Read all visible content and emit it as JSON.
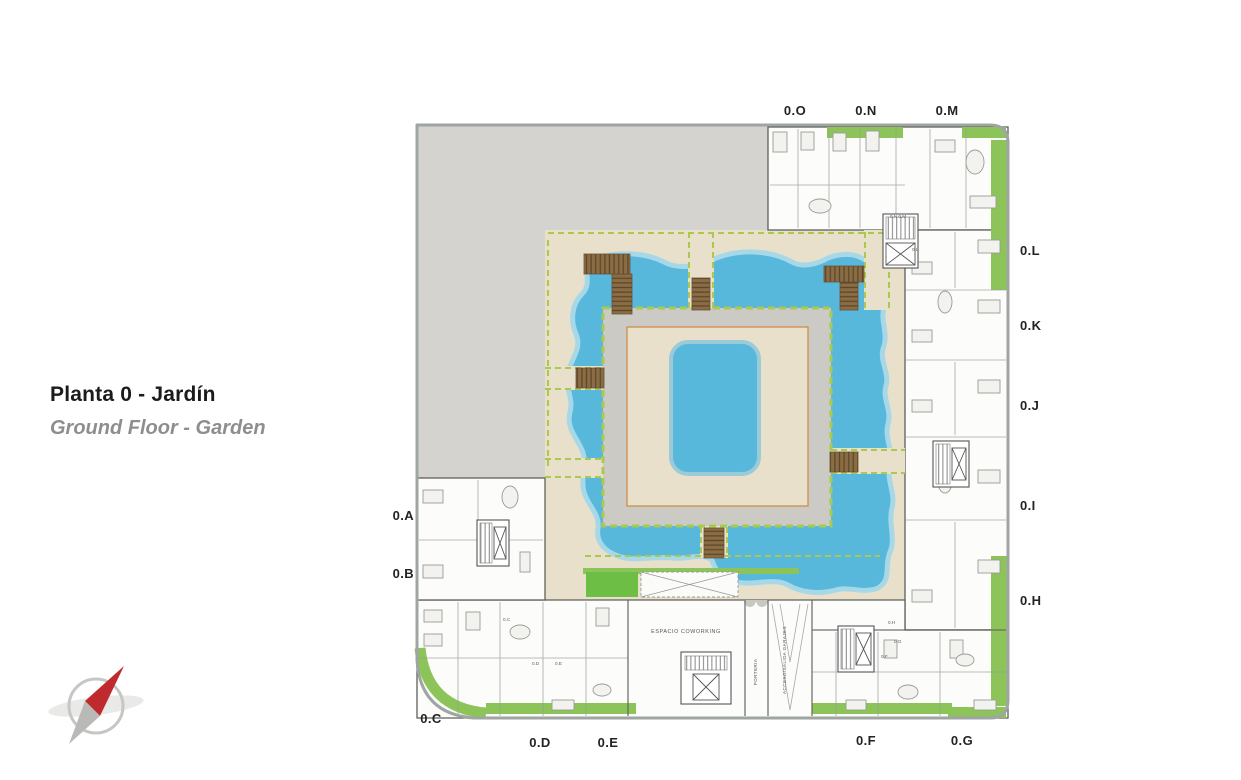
{
  "title": {
    "primary": "Planta 0 - Jardín",
    "secondary": "Ground Floor - Garden"
  },
  "plan": {
    "unit_labels": {
      "o": "0.O",
      "n": "0.N",
      "m": "0.M",
      "l": "0.L",
      "k": "0.K",
      "j": "0.J",
      "i": "0.I",
      "h": "0.H",
      "g": "0.G",
      "f": "0.F",
      "e": "0.E",
      "d": "0.D",
      "c": "0.C",
      "b": "0.B",
      "a": "0.A"
    },
    "room_labels": {
      "coworking": "ESPACIO COWORKING",
      "porteria": "PORTERIA",
      "garages": "ACCESO/SALIDA GARAJES"
    },
    "door_labels": {
      "nm": "0.N 0.M",
      "l": "0.L",
      "c": "0.C",
      "d": "0.D",
      "e": "0.E",
      "h": "0.H",
      "g": "0.G",
      "f": "0.F"
    },
    "colors": {
      "water": "#58B8DC",
      "waterlight": "#A6D8E8",
      "terrace": "#E8E0CA",
      "lawn": "#6CBE44",
      "hedge": "#A9C94F",
      "strip": "#8DC45A",
      "wood": "#8A6D45",
      "neighbor": "#D4D3CF",
      "innergray": "#CBCAC4",
      "orange": "#CC8844",
      "compassred": "#BE2A2E"
    }
  }
}
